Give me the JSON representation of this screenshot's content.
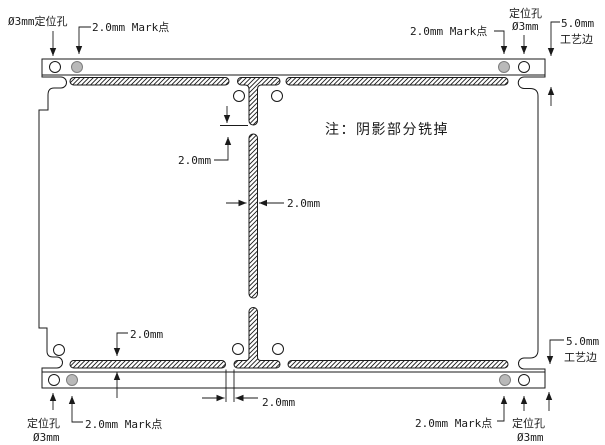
{
  "title": "PCB拼板铣槽工艺图",
  "colors": {
    "line": "#1a1a1a",
    "mark_fill": "#b9b9b9",
    "mark_stroke": "#7d7d7d",
    "note_color": "#9b9b9b",
    "background": "#ffffff"
  },
  "note": {
    "text": "注：阴影部分铣掉"
  },
  "annotations": {
    "tl": {
      "hole": "Ø3mm定位孔",
      "mark": "2.0mm Mark点"
    },
    "tr": {
      "mark": "2.0mm Mark点",
      "hole_name": "定位孔",
      "hole_size": "Ø3mm",
      "edge_size": "5.0mm",
      "edge_name": "工艺边"
    },
    "bl": {
      "hole_name": "定位孔",
      "hole_size": "Ø3mm",
      "mark": "2.0mm Mark点",
      "slot_width": "2.0mm"
    },
    "br": {
      "mark": "2.0mm Mark点",
      "hole_name": "定位孔",
      "hole_size": "Ø3mm",
      "edge_size": "5.0mm",
      "edge_name": "工艺边"
    },
    "center": {
      "gap": "2.0mm",
      "bar_width": "2.0mm",
      "tab": "2.0mm"
    }
  }
}
